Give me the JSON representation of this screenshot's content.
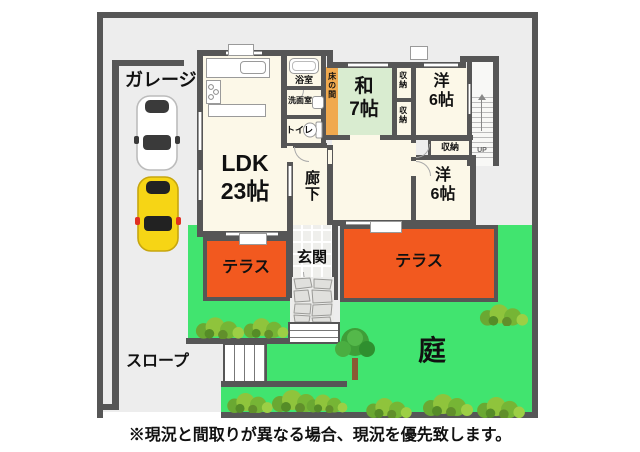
{
  "caption": "※現況と間取りが異なる場合、現況を優先致します。",
  "site": {
    "garage_label": "ガレージ",
    "slope_label": "スロープ",
    "garden_label": "庭",
    "terrace_left_label": "テラス",
    "terrace_right_label": "テラス",
    "cars": [
      {
        "type": "white-car",
        "body_color": "#ffffff"
      },
      {
        "type": "yellow-car",
        "body_color": "#f6d515"
      }
    ]
  },
  "house": {
    "ldk": {
      "name": "LDK",
      "size": "23帖"
    },
    "japanese_room": {
      "name": "和",
      "size": "7帖"
    },
    "western_room_top": {
      "name": "洋",
      "size": "6帖"
    },
    "western_room_bottom": {
      "name": "洋",
      "size": "6帖"
    },
    "bath": "浴室",
    "washroom": "洗面室",
    "toilet": "トイレ",
    "tokonoma": "床の間",
    "hallway": "廊下",
    "entrance": "玄関",
    "closet_upper": "収納",
    "closet_lower": "収納",
    "closet_middle": "収納",
    "stairs_direction": "UP"
  },
  "colors": {
    "wall": "#565656",
    "room_floor": "#fcf8e8",
    "tatami": "#d9ecd0",
    "tokonoma": "#f0a94e",
    "terrace": "#f2591f",
    "garden": "#41e46f",
    "site_ground": "#ededed",
    "car_yellow": "#f6d515"
  }
}
